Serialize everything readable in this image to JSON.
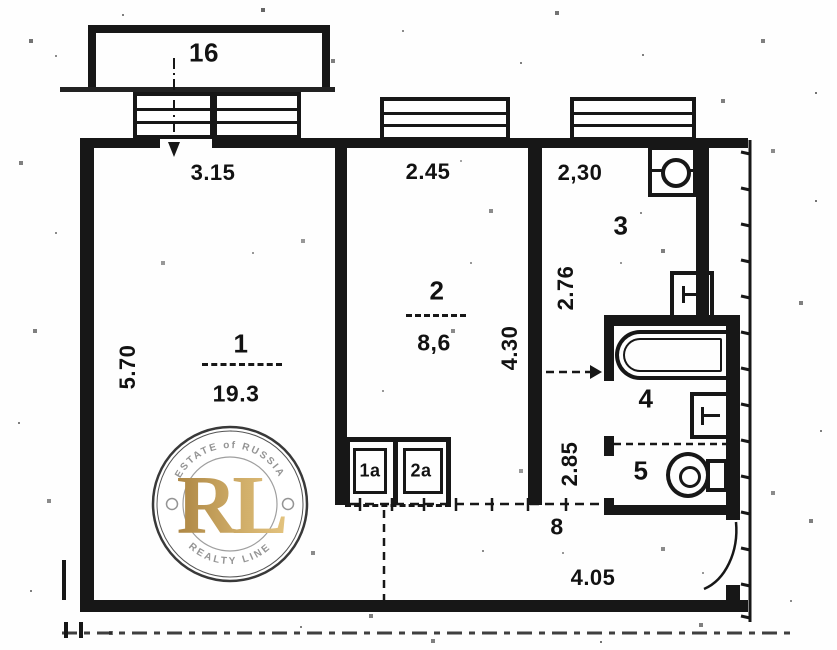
{
  "rooms": {
    "living": {
      "number": "1",
      "area": "19.3"
    },
    "room2": {
      "number": "2",
      "area": "8,6"
    },
    "kitchen": {
      "number": "3"
    },
    "bath": {
      "number": "4"
    },
    "wc": {
      "number": "5"
    },
    "hall": {
      "number": "8"
    },
    "closet_a": {
      "number": "1a"
    },
    "closet_b": {
      "number": "2a"
    },
    "balcony": {
      "number": "16"
    }
  },
  "dims": {
    "living_width": "3.15",
    "living_depth": "5.70",
    "room2_width": "2.45",
    "room2_depth": "4.30",
    "kitchen_width": "2,30",
    "kitchen_depth": "2.76",
    "hall_depth": "2.85",
    "hall_width": "4.05"
  },
  "watermark": {
    "arc_top": "ESTATE of RUSSIA",
    "arc_bottom": "REALTY LINE",
    "monogram": "RL",
    "gold_color": "#c29a4b",
    "ring_color": "#2f2f2f",
    "text_color": "#8f8f8f"
  },
  "colors": {
    "ink": "#171717",
    "paper": "#fefefe"
  }
}
